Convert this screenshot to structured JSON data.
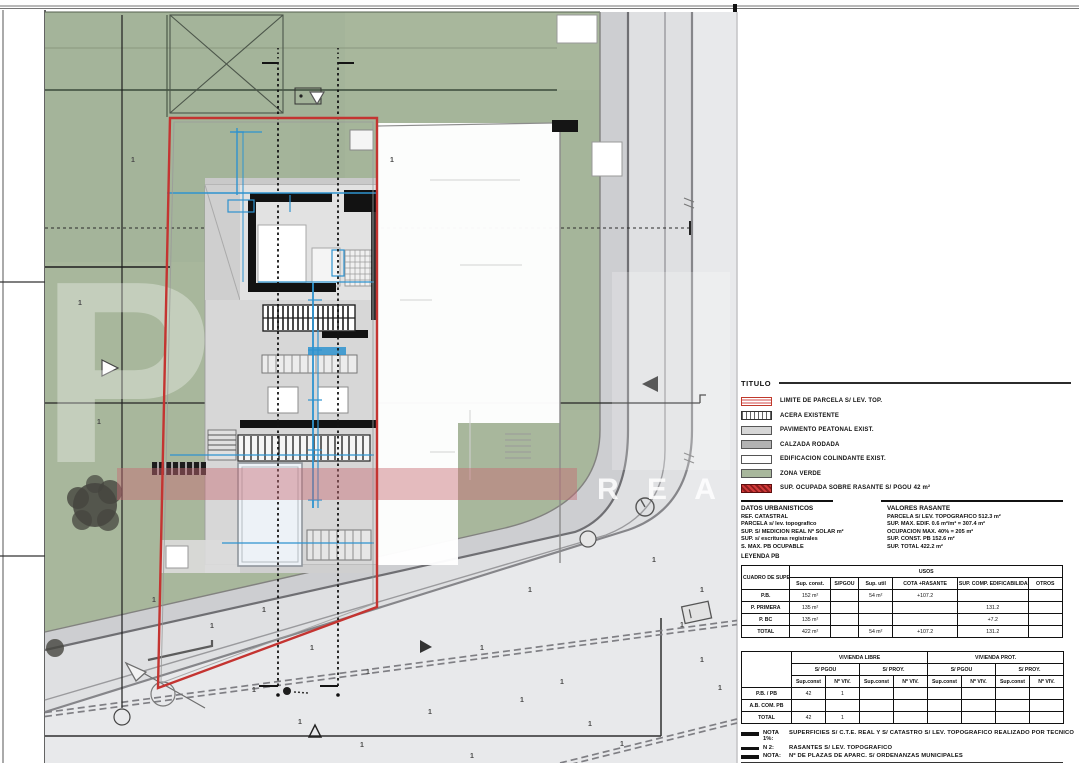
{
  "watermark": {
    "big_letter": "P",
    "rea_text": "R E A",
    "spot_glyph": "1"
  },
  "panel": {
    "title": "TITULO",
    "legend": [
      {
        "type": "boundary",
        "label": "LIMITE DE PARCELA S/ LEV. TOP."
      },
      {
        "type": "dash",
        "label": "ACERA EXISTENTE"
      },
      {
        "type": "light",
        "label": "PAVIMENTO PEATONAL EXIST."
      },
      {
        "type": "dark",
        "label": "CALZADA RODADA"
      },
      {
        "type": "white",
        "label": "EDIFICACION COLINDANTE EXIST."
      },
      {
        "type": "green",
        "label": "ZONA VERDE"
      },
      {
        "type": "occupied",
        "label": "SUP. OCUPADA SOBRE RASANTE S/ PGOU 42 m²"
      }
    ],
    "datos": {
      "header": "DATOS URBANISTICOS",
      "lines": [
        "REF. CATASTRAL",
        "PARCELA s/ lev. topografico",
        "SUP. S/ MEDICION REAL Nº SOLAR m²",
        "SUP. s/ escrituras registrales",
        "S. MAX. PB OCUPABLE"
      ],
      "footer": "LEYENDA PB"
    },
    "valores": {
      "header": "VALORES RASANTE",
      "lines": [
        "PARCELA S/ LEV. TOPOGRAFICO 512.3 m²",
        "SUP. MAX. EDIF. 0.6 m²/m² = 307.4 m²",
        "OCUPACION MAX. 40% = 205 m²",
        "SUP. CONST. PB 152.6 m²",
        "SUP. TOTAL 422.2 m²"
      ]
    },
    "table1": {
      "corner": "CUADRO DE SUPERF.",
      "group": "USOS",
      "columns": [
        "Sup. const.",
        "S/PGOU",
        "Sup. util",
        "COTA +RASANTE",
        "SUP. COMP. EDIFICABILIDAD",
        "OTROS"
      ],
      "rows": [
        {
          "label": "P.B.",
          "values": [
            "152 m²",
            "",
            "54 m²",
            "+107.2",
            "",
            ""
          ]
        },
        {
          "label": "P. PRIMERA",
          "values": [
            "135 m²",
            "",
            "",
            "",
            "131.2",
            ""
          ]
        },
        {
          "label": "P. BC",
          "values": [
            "135 m²",
            "",
            "",
            "",
            "+7.2",
            ""
          ]
        },
        {
          "label": "TOTAL",
          "values": [
            "422 m²",
            "",
            "54 m²",
            "+107.2",
            "131.2",
            ""
          ]
        }
      ]
    },
    "table2": {
      "corner": "",
      "groups": [
        "VIVIENDA LIBRE",
        "VIVIENDA PROT."
      ],
      "subs": [
        "S/ PGOU",
        "S/ PROY."
      ],
      "leaves": [
        "Sup.const",
        "Nº VIV."
      ],
      "rows": [
        {
          "label": "P.B. / PB",
          "values": [
            "42",
            "1",
            "",
            "",
            "",
            "",
            "",
            ""
          ]
        },
        {
          "label": "A.B. COM. PB",
          "values": [
            "",
            "",
            "",
            "",
            "",
            "",
            "",
            ""
          ]
        },
        {
          "label": "TOTAL",
          "values": [
            "42",
            "1",
            "",
            "",
            "",
            "",
            "",
            ""
          ]
        }
      ]
    },
    "notes": [
      {
        "label": "NOTA 1%:",
        "text": "SUPERFICIES S/ C.T.E. REAL Y S/ CATASTRO S/ LEV. TOPOGRAFICO REALIZADO POR TECNICO"
      },
      {
        "label": "N 2:",
        "text": "RASANTES S/ LEV. TOPOGRAFICO"
      },
      {
        "label": "NOTA:",
        "text": "Nº DE PLAZAS DE APARC. S/ ORDENANZAS MUNICIPALES"
      }
    ],
    "footer": {
      "left_label": "ESCALA:",
      "left_text": "LEVANTAMIENTO TOPOGRAFICO PL. 01",
      "right_label": "Nº:",
      "right_text": "02"
    }
  }
}
